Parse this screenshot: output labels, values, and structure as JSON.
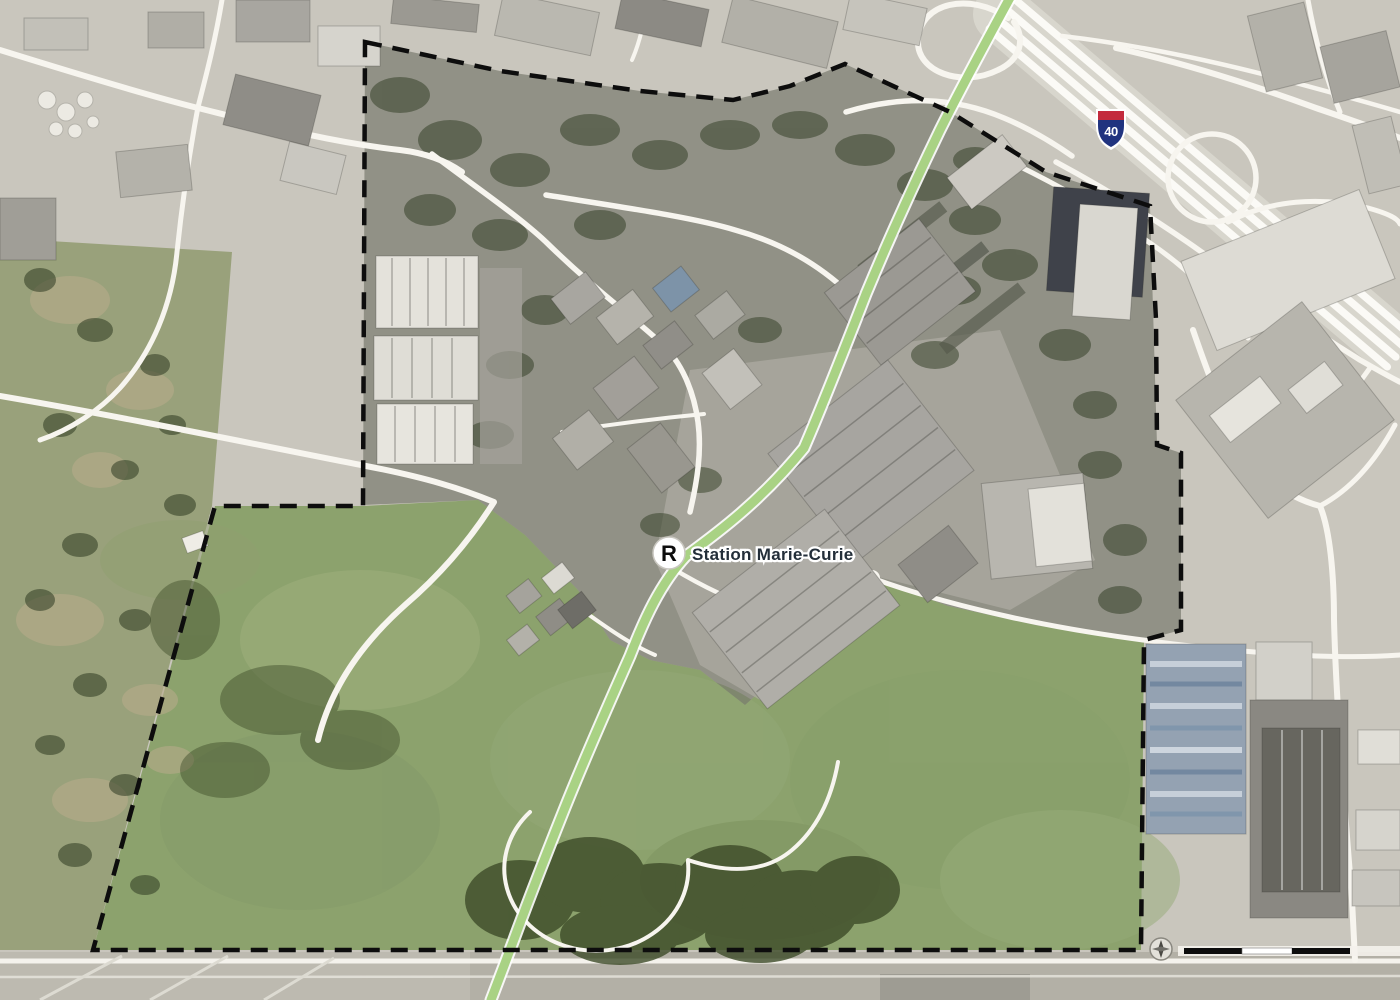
{
  "map": {
    "station": {
      "badge": "R",
      "label": "Station Marie-Curie"
    },
    "highway_shield": {
      "number": "40"
    },
    "scale_bar": {
      "black_segments": 2
    },
    "colors": {
      "rem_line": "#a9d284",
      "rem_casing": "#ffffff",
      "boundary": "#0d0d0d",
      "fields": "#8ca26d",
      "urban": "#c9c6bd",
      "golf": "#99a17b",
      "dark_overlay": "rgba(28,34,20,0.32)"
    }
  }
}
